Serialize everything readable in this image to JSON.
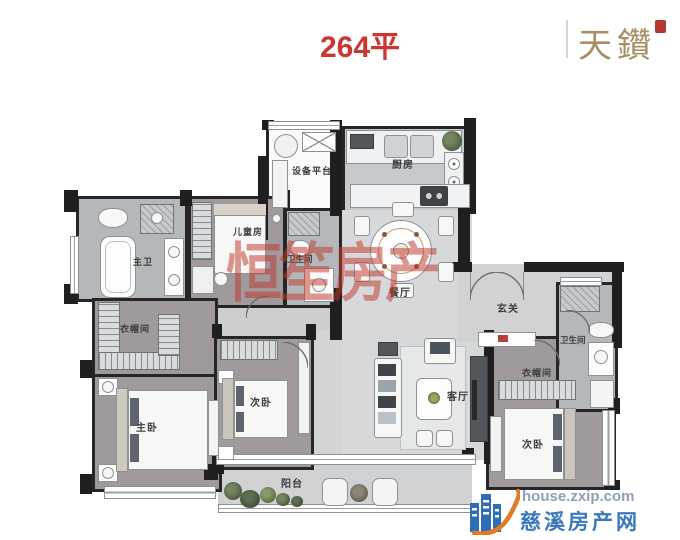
{
  "header": {
    "title": "264平",
    "brand": "天鑽"
  },
  "rooms": {
    "equipment_platform": "设备平台",
    "kitchen": "厨房",
    "dining": "餐厅",
    "foyer": "玄关",
    "children_room": "儿童房",
    "children_bath": "卫生间",
    "master_bath": "主卫",
    "cloakroom_left": "衣帽间",
    "master_bedroom": "主卧",
    "bedroom_mid": "次卧",
    "living_room": "客厅",
    "bath_right": "卫生间",
    "cloakroom_right": "衣帽间",
    "bedroom_right": "次卧",
    "balcony": "阳台"
  },
  "watermarks": {
    "center": "恒笙房产",
    "site_url": "house.zxip.com",
    "site_name": "慈溪房产网"
  },
  "colors": {
    "title_red": "#cd3530",
    "brand_gold": "#a68f63",
    "wall": "#1f1f1f",
    "bedroom_floor": "#a09a9c",
    "bath_floor": "#b4b8bb",
    "public_floor": "#d7d8d9",
    "watermark_red": "rgba(192,58,45,0.52)",
    "watermark_blue": "#3a78bd",
    "watermark_url_gray": "#8d9fb2"
  }
}
